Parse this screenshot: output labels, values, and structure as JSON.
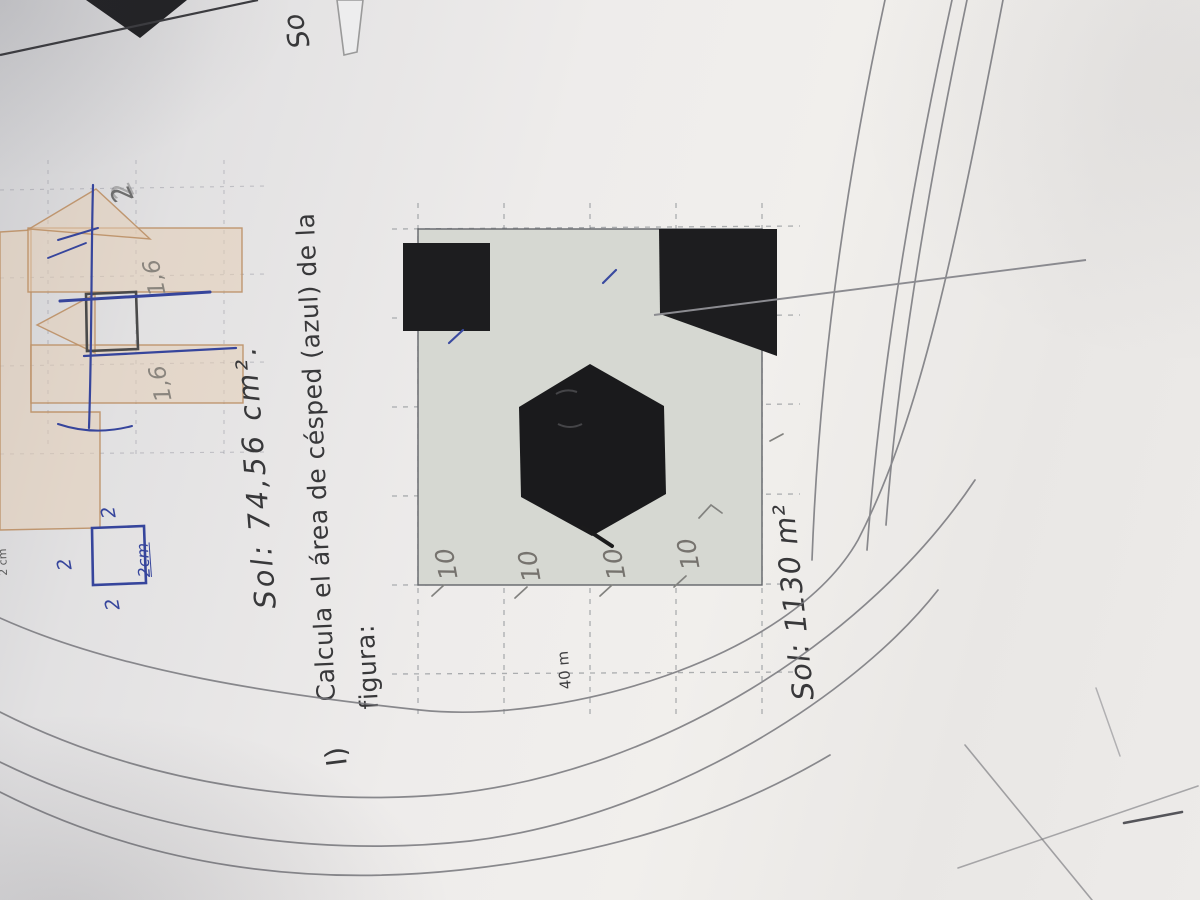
{
  "photo": {
    "prev_exercise": {
      "partial_text": "So",
      "apex_label": "2",
      "rect_label_1": "1,6",
      "rect_label_2": "1,6",
      "edge_label": "2 cm",
      "blue_label_top": "2",
      "blue_label_left": "2",
      "blue_label_bottom": "2",
      "blue_label_side": "2cm"
    },
    "exercise_h_answer": "Sol: 74,56 cm².",
    "exercise_i": {
      "number": "I)",
      "question_line1": "Calcula el área de césped (azul) de la",
      "question_line2": "figura:",
      "side_length_label": "40 m",
      "cell_labels": [
        "10",
        "10",
        "10",
        "10"
      ],
      "answer": "Sol: 1130 m²"
    },
    "colors": {
      "paper": "#eceaea",
      "printed_text": "#38383a",
      "pencil": "#77777c",
      "blue_pen": "#36459c",
      "tan_outline": "#c0906a",
      "figure_fill": "#d6d8d2",
      "figure_black": "#1b1b1b"
    }
  }
}
